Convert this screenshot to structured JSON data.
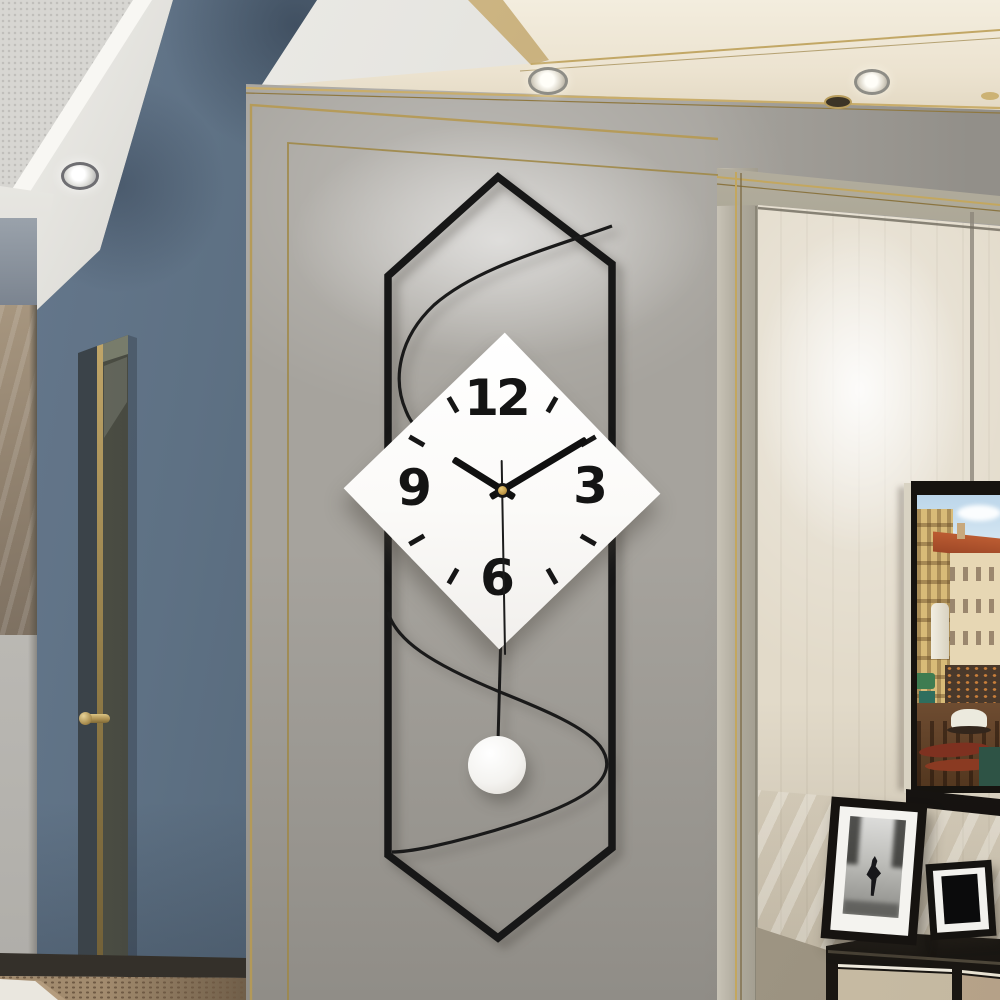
{
  "scene": {
    "type": "interior-photograph",
    "description": "Modern hallway wall with a geometric pendulum wall clock on a gray molding panel; slate-blue accent wall and door edge with brass handle at left; gold trim moldings; cream wainscot wall at right with a Venetian canal artwork on a black shelf, two leaning photo frames and a dark sideboard below; recessed ceiling spotlights"
  },
  "clock": {
    "style": "white diamond face inside elongated black hexagon wire frame with S-curve rail and round pendulum",
    "numerals": {
      "twelve": "12",
      "three": "3",
      "six": "6",
      "nine": "9"
    },
    "time": {
      "hours": 10,
      "minutes": 10,
      "seconds": 30,
      "display": "10:10:30"
    },
    "hands": {
      "hour_angle_deg": 302,
      "minute_angle_deg": 59,
      "second_angle_deg": 179
    },
    "tick_angles_deg": [
      30,
      60,
      120,
      150,
      210,
      240,
      300,
      330
    ],
    "colors": {
      "face": "#fcfcfb",
      "frame": "#171717",
      "hands": "#111111",
      "center_pin": "#c29a47",
      "pendulum_ball": "#f4f3f0"
    }
  },
  "artwork": {
    "subject": "Venetian canal scene with yellow and cream buildings, red roofs, green awnings, boats and gondolas",
    "frame_color": "#16130f",
    "edge_color": "#d9d3c3"
  },
  "photo_frames": [
    {
      "content": "black and white photograph of a dancing couple silhouette",
      "frame_color": "#161310",
      "mat_color": "#f4f3ef"
    },
    {
      "content": "dark abstract print",
      "frame_color": "#151310",
      "mat_color": "#f2f1ed"
    }
  ],
  "furniture": {
    "sideboard": "dark charcoal top and frame with light woodgrain drawer fronts and white trim lines"
  },
  "lighting": {
    "recessed_spotlights": 3,
    "small_fixtures": 2,
    "wall_glow_positions": [
      "top of gray panel behind clock",
      "center of cream wainscot wall"
    ]
  },
  "palette": {
    "blue_wall": "#5e7184",
    "gray_panel": "#a6a39d",
    "cream_wall": "#e2dac9",
    "ceiling_cream": "#ece3d0",
    "ceiling_white": "#e9e8e3",
    "gold_trim": "#c3a75f",
    "greige_molding": "#b1ac9f",
    "door_edge": "#42443b",
    "brass_handle": "#a98d4f",
    "marble_strip": "#91826f",
    "floor_mosaic": "#a28b6e",
    "cabinet_dark": "#211e19"
  }
}
